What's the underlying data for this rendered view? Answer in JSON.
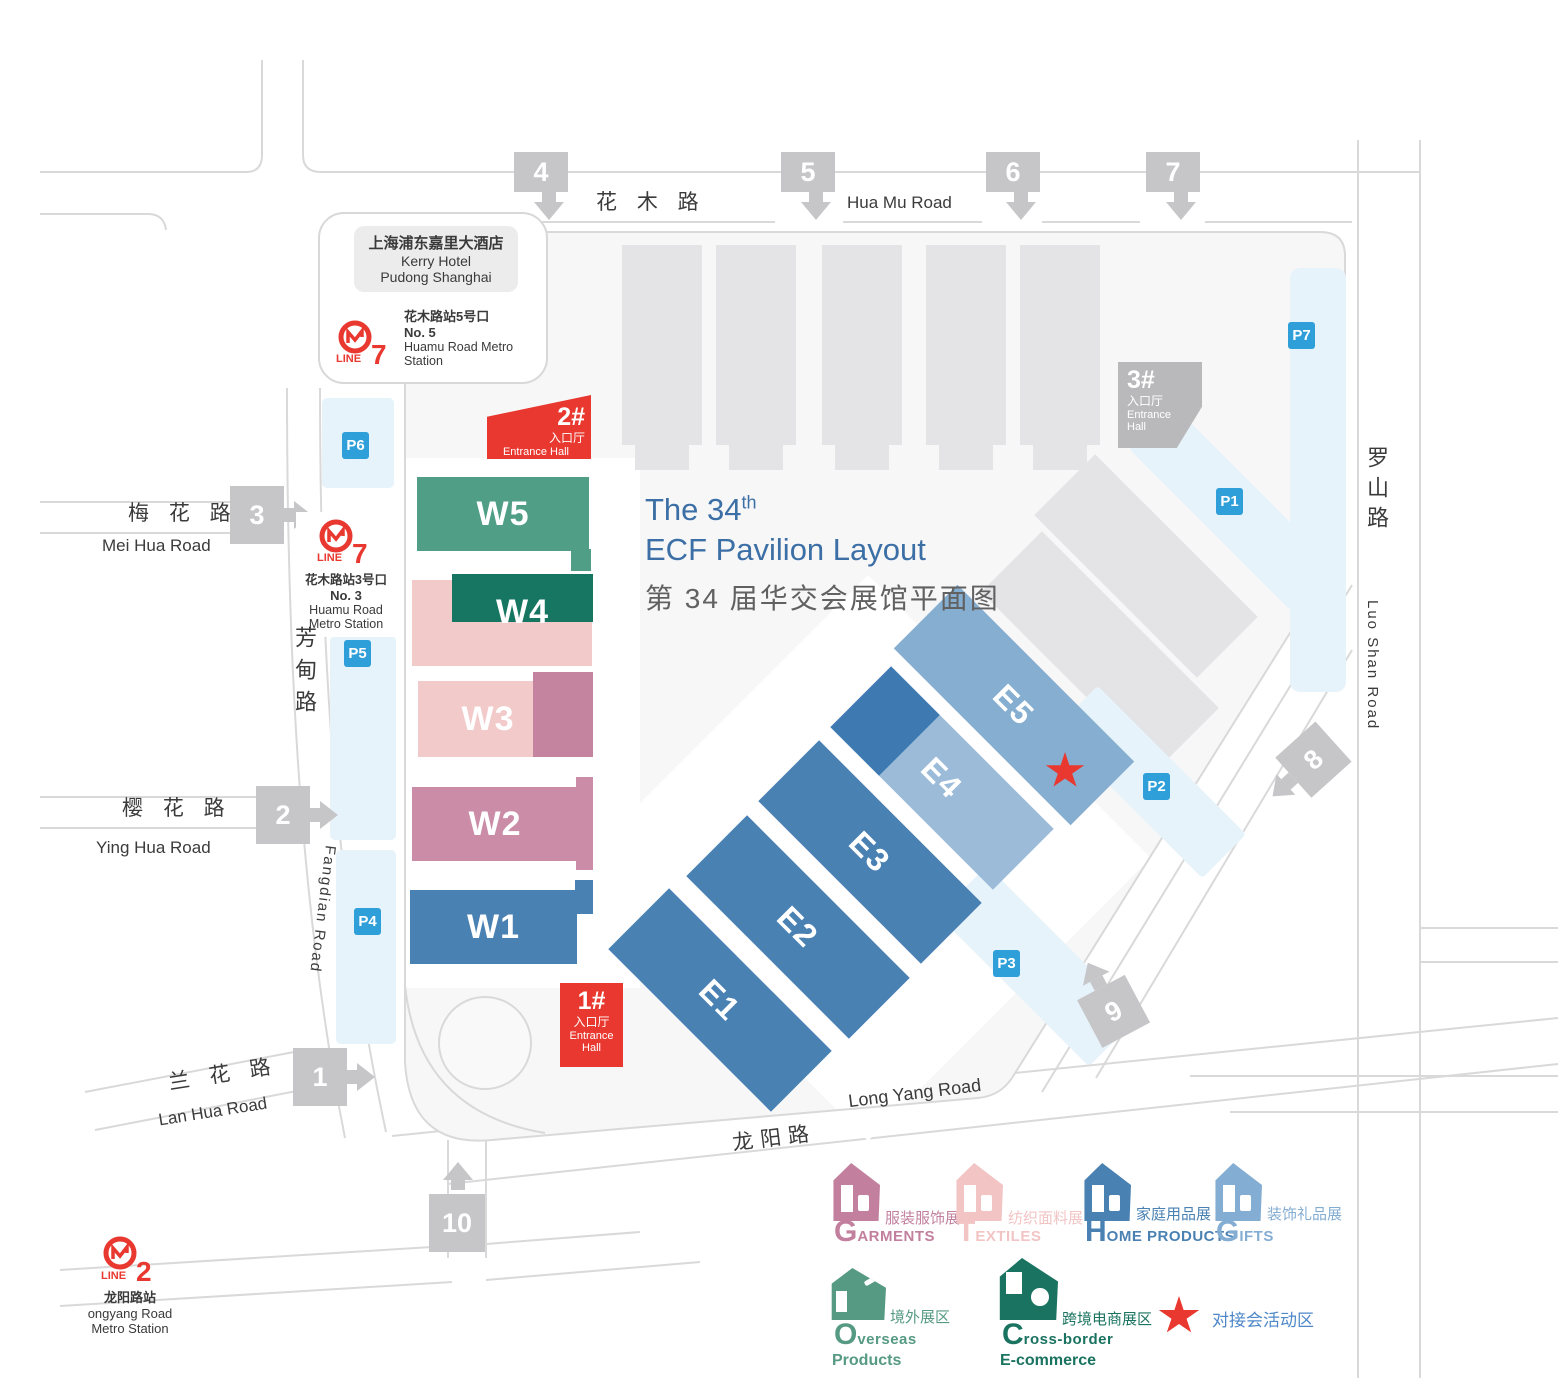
{
  "title": {
    "en_prefix": "The 34",
    "en_sup": "th",
    "en_line2": "ECF Pavilion Layout",
    "cn": "第 34 届华交会展馆平面图"
  },
  "hotel": {
    "cn": "上海浦东嘉里大酒店",
    "en1": "Kerry Hotel",
    "en2": "Pudong Shanghai"
  },
  "metro": {
    "huamu5": {
      "line_word": "LINE",
      "line_num": "7",
      "exit_cn": "花木路站5号口",
      "exit_en": "No. 5",
      "station": "Huamu Road Metro Station"
    },
    "huamu3": {
      "line_word": "LINE",
      "line_num": "7",
      "exit_cn": "花木路站3号口",
      "exit_en": "No. 3",
      "station1": "Huamu Road",
      "station2": "Metro Station"
    },
    "longyang": {
      "line_word": "LINE",
      "line_num": "2",
      "cn": "龙阳路站",
      "en1": "ongyang Road",
      "en2": "Metro Station"
    }
  },
  "roads": {
    "huamu_cn": "花 木 路",
    "huamu_en": "Hua Mu Road",
    "meihua_cn": "梅 花 路",
    "meihua_en": "Mei Hua Road",
    "yinghua_cn": "樱 花 路",
    "yinghua_en": "Ying Hua Road",
    "lanhua_cn": "兰 花 路",
    "lanhua_en": "Lan Hua Road",
    "fangdian_cn": "芳甸路",
    "fangdian_en": "Fangdian Road",
    "longyang_cn": "龙阳路",
    "longyang_en": "Long Yang Road",
    "luoshan_cn": "罗山路",
    "luoshan_en": "Luo Shan Road"
  },
  "gates": [
    {
      "label": "1"
    },
    {
      "label": "2"
    },
    {
      "label": "3"
    },
    {
      "label": "4"
    },
    {
      "label": "5"
    },
    {
      "label": "6"
    },
    {
      "label": "7"
    },
    {
      "label": "8"
    },
    {
      "label": "9"
    },
    {
      "label": "10"
    }
  ],
  "parking": [
    {
      "label": "P1"
    },
    {
      "label": "P2"
    },
    {
      "label": "P3"
    },
    {
      "label": "P4"
    },
    {
      "label": "P5"
    },
    {
      "label": "P6"
    },
    {
      "label": "P7"
    }
  ],
  "entrances": [
    {
      "num": "1#",
      "cn": "入口厅",
      "en": "Entrance Hall"
    },
    {
      "num": "2#",
      "cn": "入口厅",
      "en": "Entrance Hall"
    },
    {
      "num": "3#",
      "cn": "入口厅",
      "en": "Entrance Hall"
    }
  ],
  "halls": {
    "west": [
      {
        "label": "W1"
      },
      {
        "label": "W2"
      },
      {
        "label": "W3"
      },
      {
        "label": "W4"
      },
      {
        "label": "W5"
      }
    ],
    "east": [
      {
        "label": "E1"
      },
      {
        "label": "E2"
      },
      {
        "label": "E3"
      },
      {
        "label": "E4"
      },
      {
        "label": "E5"
      }
    ]
  },
  "legend": [
    {
      "initial": "G",
      "rest": "ARMENTS",
      "cn": "服装服饰展"
    },
    {
      "initial": "T",
      "rest": "EXTILES",
      "cn": "纺织面料展"
    },
    {
      "initial": "H",
      "rest": "OME PRODUCTS",
      "cn": "家庭用品展"
    },
    {
      "initial": "G",
      "rest": "IFTS",
      "cn": "装饰礼品展"
    },
    {
      "initial": "O",
      "rest": "verseas",
      "line2": "Products",
      "cn": "境外展区"
    },
    {
      "initial": "C",
      "rest": "ross-border",
      "line2": "E-commerce",
      "cn": "跨境电商展区"
    },
    {
      "cn": "对接会活动区"
    }
  ],
  "colors": {
    "red": "#e8382f",
    "parking_badge": "#2e9fd9",
    "parking_area": "#e7f3fb",
    "hall_blue": "#4a81b3",
    "hall_blue_light": "#86aed1",
    "hall_blue_pale": "#9cbbd9",
    "hall_blue_dark": "#3e7ab1",
    "green": "#4f9e85",
    "teal": "#177661",
    "pink_light": "#f2caca",
    "mauve": "#c4839f",
    "rose": "#ca8ca7",
    "gray_building": "#e4e4e6",
    "gate_gray": "#c6c6c8",
    "entrance3_gray": "#b9b9bb",
    "title_blue": "#3c6fa5",
    "legend_garments": "#c2809e",
    "legend_textiles": "#f2c4c4",
    "legend_home": "#4a81b3",
    "legend_gifts": "#84add3",
    "legend_overseas": "#569a83",
    "legend_crossborder": "#1a7360",
    "legend_star_text": "#4f88c8"
  }
}
